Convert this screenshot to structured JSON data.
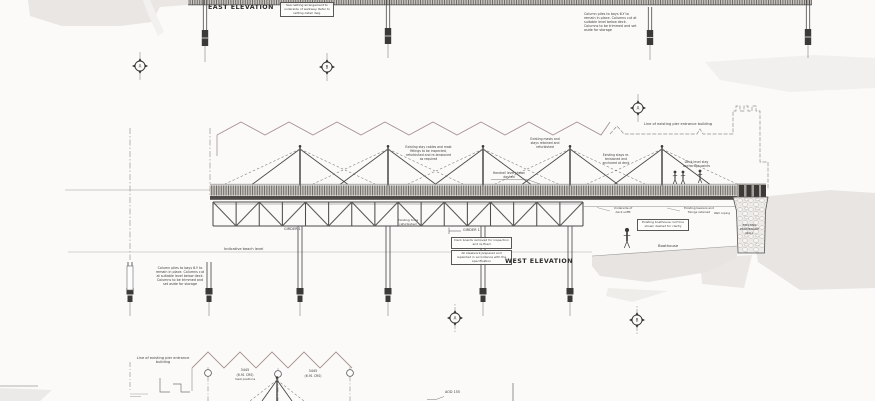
{
  "sheet": {
    "east_elevation": {
      "title": "EAST ELEVATION",
      "note_box": "Sea netting arrangement to underside of walkway. Refer to netting detail dwg.",
      "pile_note": "Column piles to bays 6-Y to remain in place. Columns cut at suitable level below deck. Columns to be trimmed and set aside for storage",
      "grid_markers": [
        "A",
        "B"
      ]
    },
    "west_elevation": {
      "title": "WEST ELEVATION",
      "building_line_label": "Line of existing pier entrance building",
      "stay_note_1": "Existing stay cables and mast fittings to be inspected, refurbished and re-tensioned as required",
      "stay_note_2": "Existing masts and stays retained and refurbished",
      "stay_note_3": "Existing stays re-tensioned and anchored at deck",
      "stay_note_4": "Deck level stay anchorage points",
      "handrail_label": "Handrail level shown dashed",
      "girder_label": "GIRDER 1",
      "truss_note": "Existing truss refurbished",
      "beach_label": "Indicative beach level",
      "pile_note": "Column piles to bays 6-Y to remain in place. Columns cut at suitable level below deck. Columns to be trimmed and set aside for storage",
      "note_box_1": "Deck boards removed for inspection and re-fixed",
      "note_box_2": "All steelwork prepared and repainted in accordance with the specification",
      "soffit_note": "Underside of deck soffit",
      "bearer_note": "Existing bearers and fixings retained",
      "boathouse_box": "Existing boathouse roof line shown dashed for clarity",
      "boathouse_label": "Boathouse",
      "wall_label": "EXISTING PROMENADE WALL",
      "coping_label": "Wall coping",
      "grid_markers": [
        "A",
        "B",
        "A"
      ]
    },
    "lower_elevation": {
      "building_line_label": "Line of existing pier entrance building",
      "dim_1_value": "3445",
      "dim_1_unit": "(6.91 CRS)",
      "dim_1_note": "mast positions",
      "dim_2_value": "3445",
      "dim_2_unit": "(6.91 CRS)",
      "level_label": "AOD 155"
    }
  },
  "palette": {
    "paper": "#fbfaf9",
    "line": "#4a4a4a",
    "shading": "#e9e6e3",
    "roofline": "#a5938e"
  }
}
